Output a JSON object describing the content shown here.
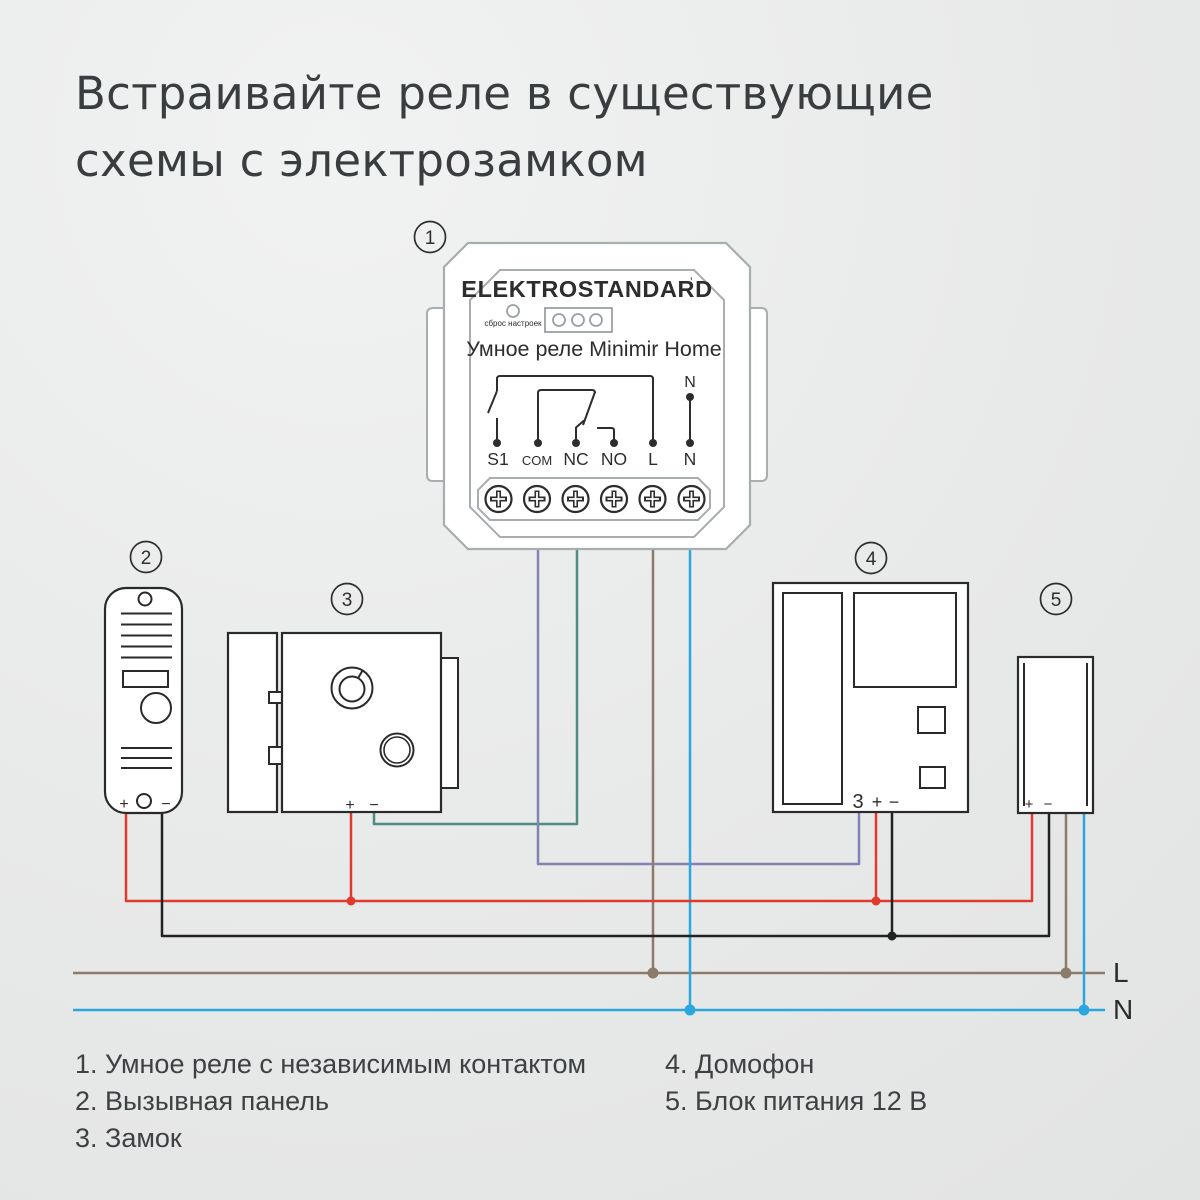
{
  "title": {
    "line1": "Встраивайте реле в существующие",
    "line2": "схемы с электрозамком"
  },
  "relay": {
    "badge": "1",
    "brand": "ELEKTROSTANDARD",
    "brand_mark": "’",
    "reset_label": "сброс настроек",
    "model": "Умное реле Minimir Home",
    "n_top": "N",
    "terminals": [
      "S1",
      "COM",
      "NC",
      "NO",
      "L",
      "N"
    ]
  },
  "call_panel": {
    "badge": "2",
    "plus": "+",
    "minus": "−"
  },
  "lock": {
    "badge": "3",
    "plus": "+",
    "minus": "−"
  },
  "intercom": {
    "badge": "4",
    "t3": "3",
    "plus": "+",
    "minus": "−"
  },
  "psu": {
    "badge": "5",
    "plus": "+",
    "minus": "−"
  },
  "bus": {
    "l": "L",
    "n": "N"
  },
  "legend": {
    "left": [
      "1. Умное реле с независимым контактом",
      "2. Вызывная панель",
      "3. Замок"
    ],
    "right": [
      "4. Домофон",
      "5. Блок питания 12 В"
    ]
  },
  "colors": {
    "red": "#de3a30",
    "black": "#222222",
    "blue": "#2ca6de",
    "brown": "#8b7b6b",
    "purple": "#8382b5",
    "teal": "#4e8b81",
    "relay_outline": "#a8adb0",
    "ink": "#2a2a2a",
    "text": "#3b3e40"
  }
}
